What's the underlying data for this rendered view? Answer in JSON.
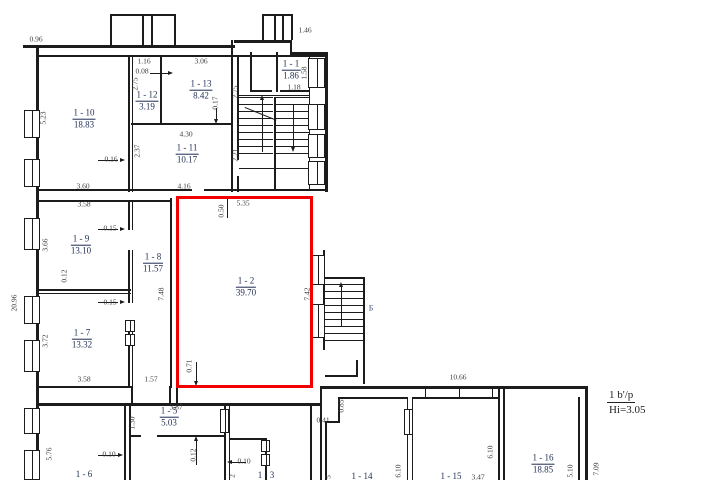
{
  "colors": {
    "wall": "#1c1c1c",
    "dim_text": "#3c3c3c",
    "room_text": "#1e2c52",
    "highlight": "#f20000",
    "stair_letter": "#44567f"
  },
  "legend": {
    "floor_note_top": "1 b'/p",
    "floor_note_bottom": "Hi=3.05"
  },
  "stairs": {
    "label": "Б"
  },
  "rooms": [
    {
      "number": "1 - 10",
      "area": "18.83",
      "x": 84,
      "y": 119
    },
    {
      "number": "1 - 12",
      "area": "3.19",
      "x": 147,
      "y": 101
    },
    {
      "number": "1 - 13",
      "area": "8.42",
      "x": 201,
      "y": 90
    },
    {
      "number": "1 - 11",
      "area": "10.17",
      "x": 187,
      "y": 154
    },
    {
      "number": "1 - 1",
      "area": "1.86",
      "x": 291,
      "y": 70
    },
    {
      "number": "1 - 9",
      "area": "13.10",
      "x": 81,
      "y": 245
    },
    {
      "number": "1 - 8",
      "area": "11.57",
      "x": 153,
      "y": 263
    },
    {
      "number": "1 - 7",
      "area": "13.32",
      "x": 82,
      "y": 339
    },
    {
      "number": "1 - 2",
      "area": "39.70",
      "x": 246,
      "y": 287
    },
    {
      "number": "1 - 6",
      "area": "",
      "x": 84,
      "y": 475
    },
    {
      "number": "1 - 5",
      "area": "5.03",
      "x": 169,
      "y": 417
    },
    {
      "number": "1 - 3",
      "area": "",
      "x": 266,
      "y": 476
    },
    {
      "number": "1 - 14",
      "area": "",
      "x": 362,
      "y": 477
    },
    {
      "number": "1 - 15",
      "area": "",
      "x": 451,
      "y": 477
    },
    {
      "number": "1 - 16",
      "area": "18.85",
      "x": 543,
      "y": 464
    }
  ],
  "dimensions": [
    {
      "t": "0.96",
      "x": 36,
      "y": 39
    },
    {
      "t": "1.46",
      "x": 305,
      "y": 30
    },
    {
      "t": "1.16",
      "x": 144,
      "y": 61
    },
    {
      "t": "0.08",
      "x": 142,
      "y": 71
    },
    {
      "t": "3.06",
      "x": 201,
      "y": 61
    },
    {
      "t": "2.75",
      "x": 135,
      "y": 84,
      "v": 1
    },
    {
      "t": "2.75",
      "x": 235,
      "y": 92,
      "v": 1
    },
    {
      "t": "0.17",
      "x": 215,
      "y": 103,
      "v": 1
    },
    {
      "t": "5.23",
      "x": 43,
      "y": 118,
      "v": 1
    },
    {
      "t": "4.30",
      "x": 186,
      "y": 134
    },
    {
      "t": "0.16",
      "x": 111,
      "y": 159
    },
    {
      "t": "2.37",
      "x": 137,
      "y": 151,
      "v": 1
    },
    {
      "t": "2.21",
      "x": 235,
      "y": 155,
      "v": 1
    },
    {
      "t": "3.60",
      "x": 83,
      "y": 186
    },
    {
      "t": "4.16",
      "x": 184,
      "y": 186
    },
    {
      "t": "1.18",
      "x": 294,
      "y": 87
    },
    {
      "t": "1.58",
      "x": 304,
      "y": 73,
      "v": 1
    },
    {
      "t": "3.58",
      "x": 84,
      "y": 204
    },
    {
      "t": "3.66",
      "x": 45,
      "y": 245,
      "v": 1
    },
    {
      "t": "0.15",
      "x": 110,
      "y": 228
    },
    {
      "t": "0.15",
      "x": 110,
      "y": 302
    },
    {
      "t": "0.12",
      "x": 64,
      "y": 276,
      "v": 1
    },
    {
      "t": "3.72",
      "x": 45,
      "y": 341,
      "v": 1
    },
    {
      "t": "3.58",
      "x": 84,
      "y": 379
    },
    {
      "t": "1.57",
      "x": 151,
      "y": 379
    },
    {
      "t": "0.50",
      "x": 221,
      "y": 211,
      "v": 1
    },
    {
      "t": "5.35",
      "x": 243,
      "y": 203
    },
    {
      "t": "7.42",
      "x": 307,
      "y": 294,
      "v": 1
    },
    {
      "t": "7.48",
      "x": 161,
      "y": 294,
      "v": 1
    },
    {
      "t": "0.71",
      "x": 189,
      "y": 366,
      "v": 1
    },
    {
      "t": "20.96",
      "x": 14,
      "y": 303,
      "v": 1
    },
    {
      "t": "5.76",
      "x": 49,
      "y": 454,
      "v": 1
    },
    {
      "t": "0.10",
      "x": 109,
      "y": 454
    },
    {
      "t": "3.87",
      "x": 176,
      "y": 407
    },
    {
      "t": "1.30",
      "x": 132,
      "y": 423,
      "v": 1
    },
    {
      "t": "0.12",
      "x": 193,
      "y": 455,
      "v": 1
    },
    {
      "t": "0.10",
      "x": 244,
      "y": 461
    },
    {
      "t": "2",
      "x": 232,
      "y": 476,
      "v": 1
    },
    {
      "t": "0.85",
      "x": 341,
      "y": 406,
      "v": 1
    },
    {
      "t": "0.41",
      "x": 323,
      "y": 420
    },
    {
      "t": "10.66",
      "x": 458,
      "y": 377
    },
    {
      "t": "6.10",
      "x": 398,
      "y": 471,
      "v": 1
    },
    {
      "t": "6.10",
      "x": 490,
      "y": 452,
      "v": 1
    },
    {
      "t": "3.47",
      "x": 478,
      "y": 477
    },
    {
      "t": "5",
      "x": 328,
      "y": 477,
      "v": 1
    },
    {
      "t": "5.10",
      "x": 570,
      "y": 471,
      "v": 1
    },
    {
      "t": "7.09",
      "x": 596,
      "y": 469,
      "v": 1
    }
  ]
}
